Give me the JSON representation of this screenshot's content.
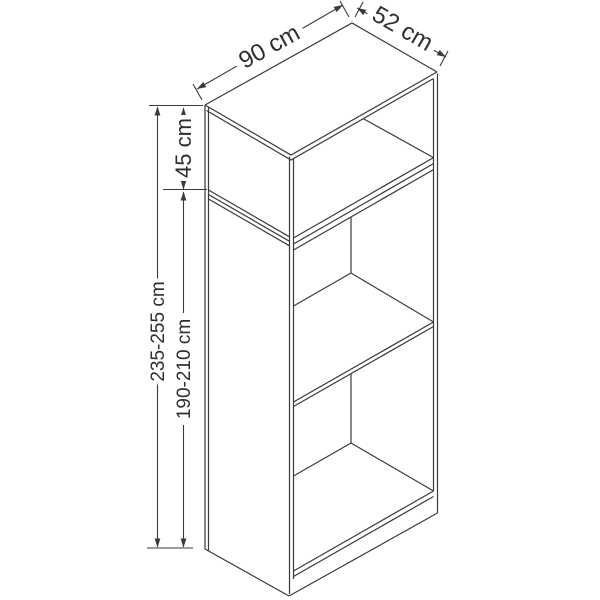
{
  "page": {
    "background": "#ffffff"
  },
  "drawing": {
    "subject": "wardrobe-technical-line-drawing",
    "line_color": "#3a3a3a",
    "text_color": "#2e2e2e",
    "labels": {
      "width_top": "90 cm",
      "depth_top": "52 cm",
      "upper_cabinet_height": "45 cm",
      "overall_height": "235-255 cm",
      "lower_cabinet_height": "190-210 cm"
    }
  }
}
